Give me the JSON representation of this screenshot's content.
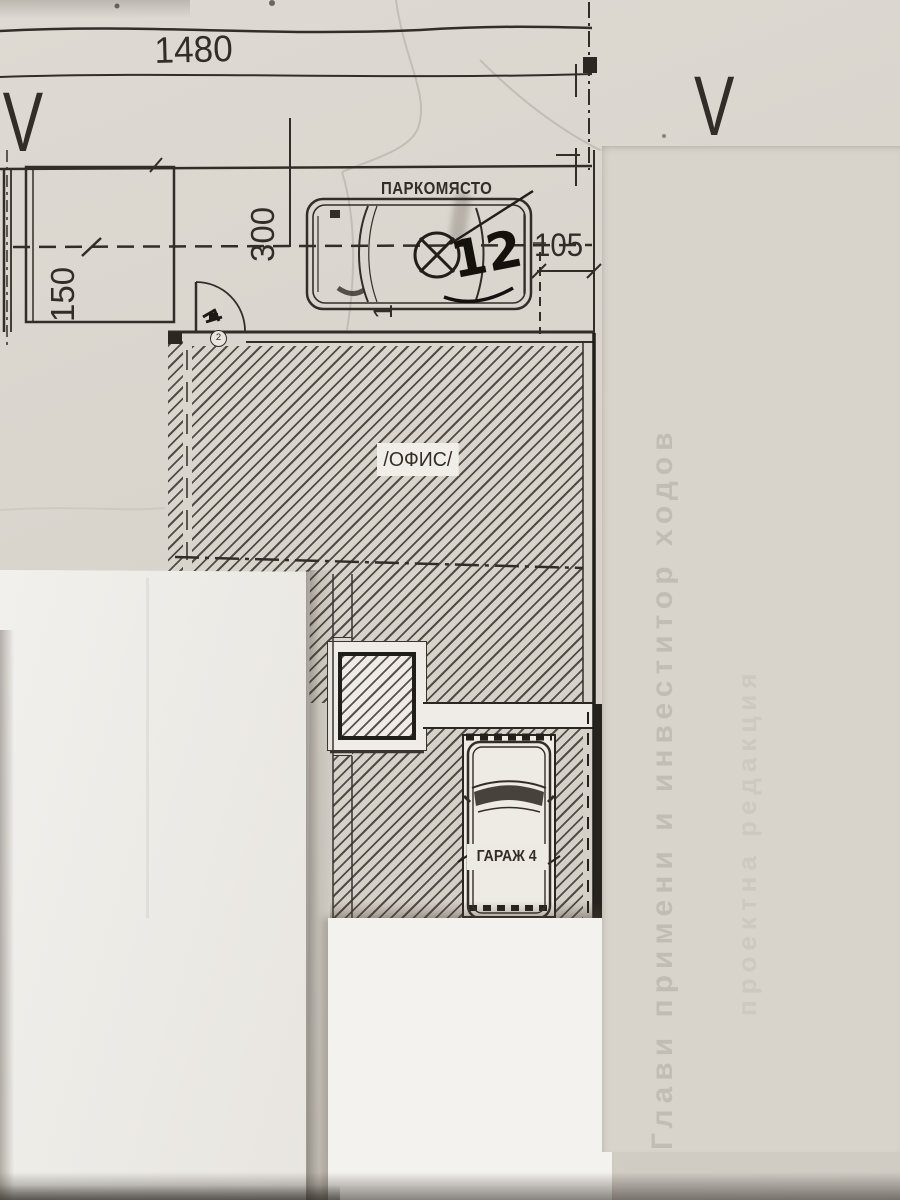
{
  "page": {
    "kind": "Photographed architectural floor plan with overlapping white paper sheets"
  },
  "labels": {
    "dim_top": "1480",
    "grid_left": "IV",
    "grid_right": "V",
    "parking_title": "ПАРКОМЯСТО",
    "parking_number_handwritten": "12",
    "dim_right": "105",
    "dim_left_vertical": "150",
    "dim_mid_vertical": "300",
    "dim_partial_vertical": "1",
    "office_label": "/ОФИС/",
    "garage_label": "ГАРАЖ 4",
    "door_mark": "2",
    "bleedthrough_line1": "Глави примени и инвеститор ходов",
    "bleedthrough_line2": "проектна редакция"
  },
  "colors": {
    "paper": "#d9d5cd",
    "overlay_sheet": "#f1efea",
    "ink": "#332d27",
    "wall_fill": "#26221d"
  }
}
